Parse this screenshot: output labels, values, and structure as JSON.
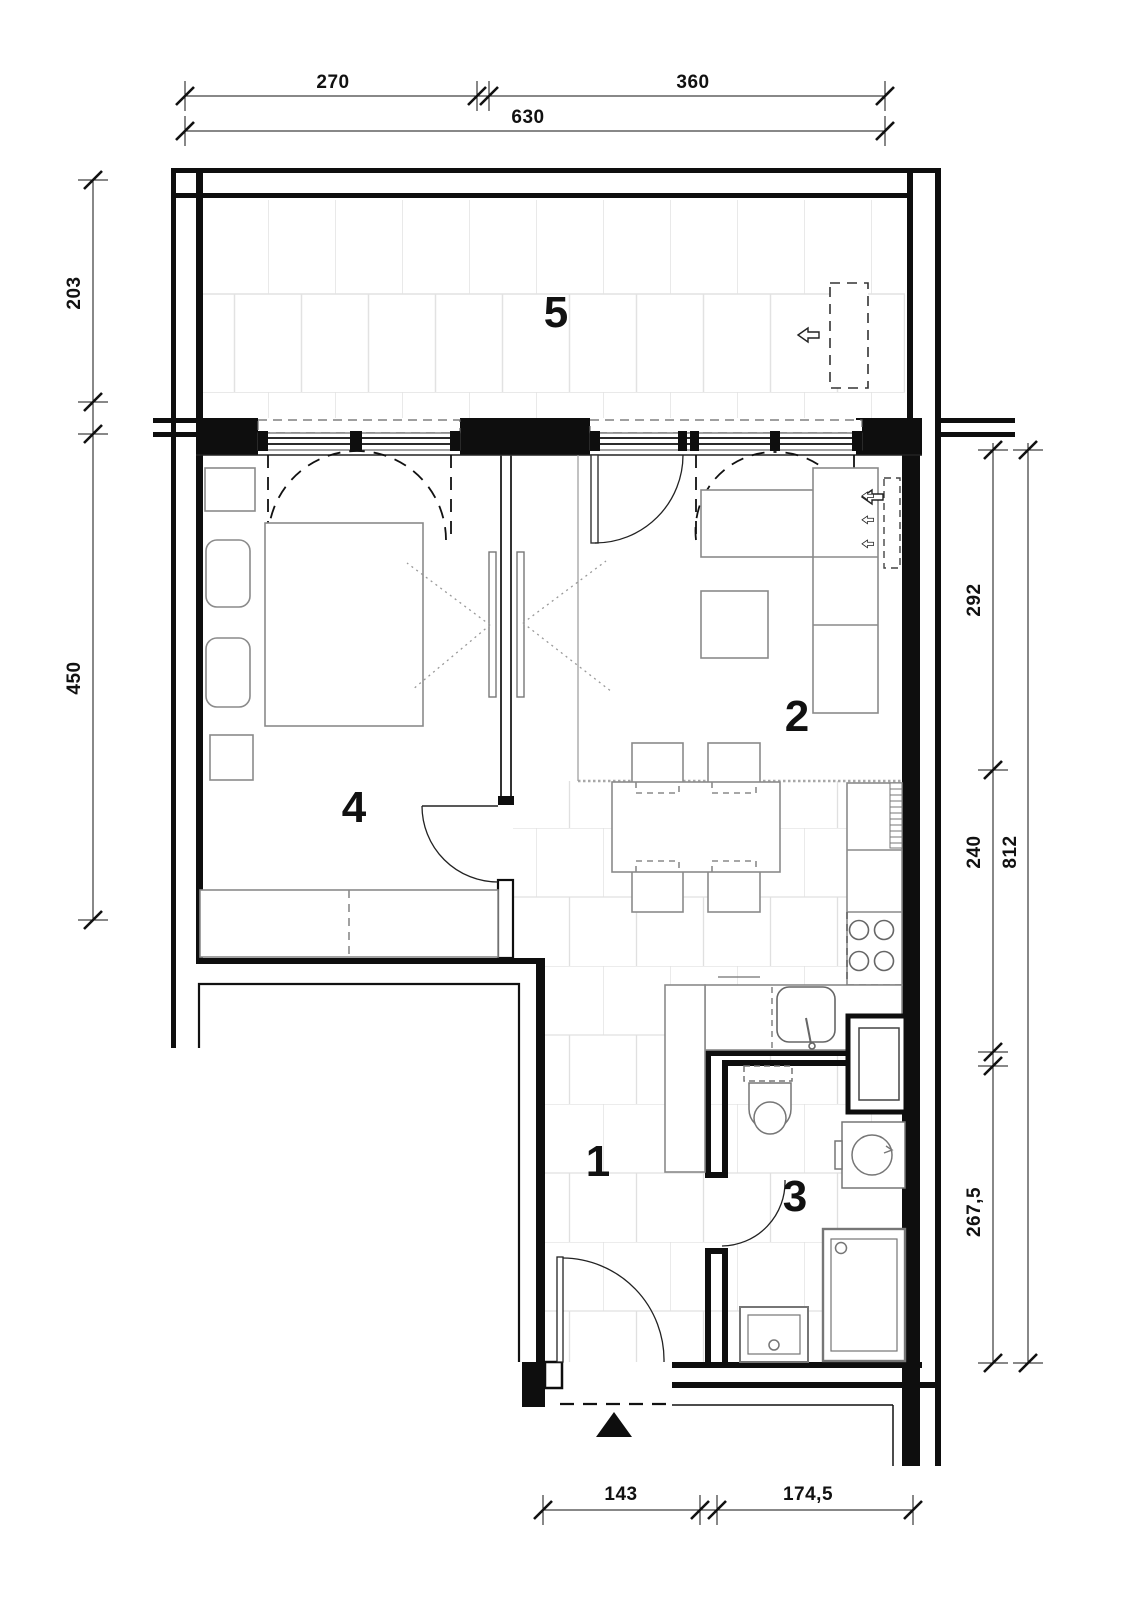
{
  "plan": {
    "type": "apartment-floor-plan",
    "rooms": [
      {
        "number": "1",
        "name": "hallway-kitchen",
        "floor": "tiles"
      },
      {
        "number": "2",
        "name": "living-room",
        "floor": "plain"
      },
      {
        "number": "3",
        "name": "bathroom",
        "floor": "tiles"
      },
      {
        "number": "4",
        "name": "bedroom",
        "floor": "plain"
      },
      {
        "number": "5",
        "name": "balcony",
        "floor": "large-tiles"
      }
    ],
    "dimensions": {
      "top": [
        "270",
        "360",
        "630"
      ],
      "left": [
        "203",
        "450"
      ],
      "right": [
        "292",
        "240",
        "267,5",
        "812"
      ],
      "bottom": [
        "143",
        "174,5"
      ]
    },
    "furniture": [
      "double-bed",
      "pillows",
      "nightstands",
      "wardrobe",
      "sliding-door",
      "corner-sofa",
      "coffee-table",
      "dining-table",
      "four-chairs",
      "kitchen-counter",
      "stove-4-burners",
      "kitchen-sink",
      "tall-cabinet",
      "toilet",
      "washing-machine",
      "shower-tray",
      "wash-basin",
      "duct-shaft",
      "radiator",
      "balcony-unit",
      "entrance-arrow"
    ],
    "colors": {
      "wall": "#0e0e0e",
      "furniture_line": "#868686",
      "tile_line": "#e2e2e2",
      "dashed_symbol": "#3a3a3a",
      "background": "#ffffff"
    }
  }
}
